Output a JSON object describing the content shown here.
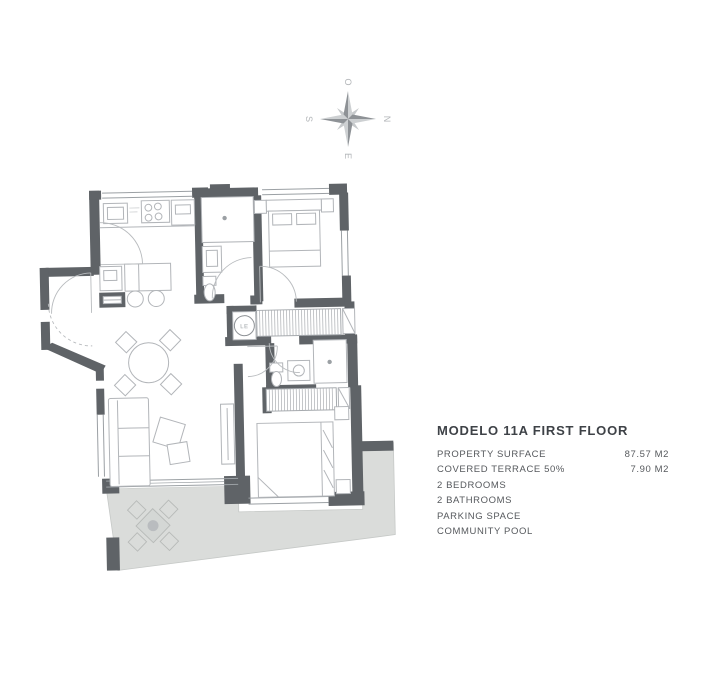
{
  "info_panel": {
    "title": "MODELO 11A FIRST FLOOR",
    "specs": [
      {
        "label": "PROPERTY SURFACE",
        "value": "87.57 M2"
      },
      {
        "label": "COVERED TERRACE 50%",
        "value": "7.90 M2"
      },
      {
        "label": "2 BEDROOMS",
        "value": ""
      },
      {
        "label": "2 BATHROOMS",
        "value": ""
      },
      {
        "label": "PARKING SPACE",
        "value": ""
      },
      {
        "label": "COMMUNITY POOL",
        "value": ""
      }
    ]
  },
  "compass": {
    "north": "N",
    "east": "E",
    "south": "S",
    "west": "O"
  },
  "floor_plan": {
    "washer_label": "LE"
  },
  "colors": {
    "wall": "#5f6367",
    "terrace": "#dadcda",
    "furniture_line": "#b2b5b9",
    "text": "#56595d"
  }
}
